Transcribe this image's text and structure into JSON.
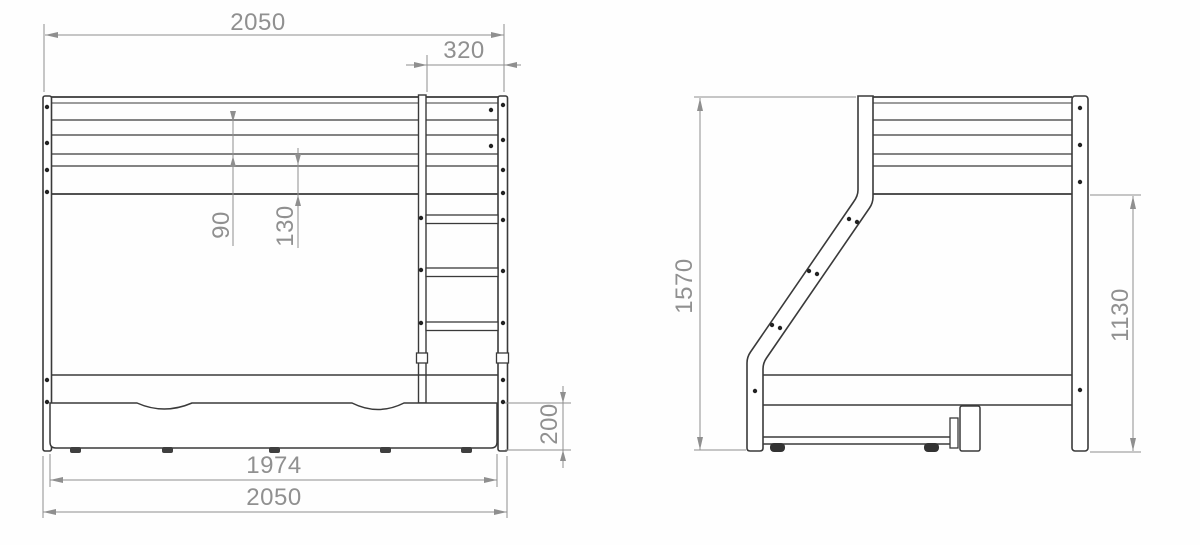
{
  "drawing": {
    "type": "technical-drawing",
    "subject": "bunk bed with storage drawer, front and side elevation",
    "front_view": {
      "dims": {
        "overall_width_top": "2050",
        "ladder_width": "320",
        "rail_gap_upper": "90",
        "rail_gap_lower": "130",
        "drawer_height": "200",
        "drawer_width": "1974",
        "overall_width_bottom": "2050"
      }
    },
    "side_view": {
      "dims": {
        "overall_height": "1570",
        "under_bunk_height": "1130"
      }
    },
    "colors": {
      "line": "#3a3a3a",
      "dimension_line": "#8f8f8f",
      "dimension_text": "#909090",
      "background": "#fefefe"
    }
  }
}
